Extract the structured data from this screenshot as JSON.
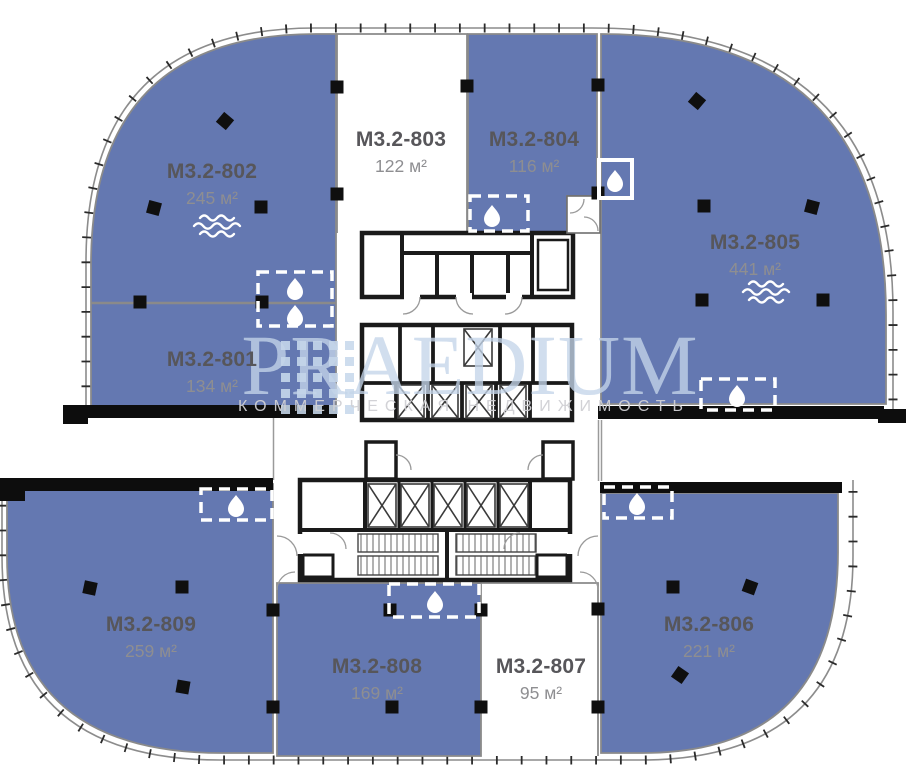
{
  "plan": {
    "name": "Floor plan M3.2 — level 8",
    "background": "#ffffff"
  },
  "watermark": {
    "title": "PRAEDIUM",
    "subtitle": "КОММЕРЧЕСКАЯ НЕДВИЖИМОСТЬ"
  },
  "colors": {
    "available_fill": "#6478b1",
    "unavailable_fill": "#ffffff",
    "wall": "#111111",
    "boundary_line": "#8a8a8a",
    "unit_name_text": "#57565a",
    "unit_area_text": "#8e8e91"
  },
  "units": [
    {
      "id": "M3.2-801",
      "area": "134 м²",
      "status": "available"
    },
    {
      "id": "M3.2-802",
      "area": "245 м²",
      "status": "available",
      "has_wave_icon": true
    },
    {
      "id": "M3.2-803",
      "area": "122 м²",
      "status": "unavailable"
    },
    {
      "id": "M3.2-804",
      "area": "116 м²",
      "status": "available"
    },
    {
      "id": "M3.2-805",
      "area": "441 м²",
      "status": "available",
      "has_wave_icon": true
    },
    {
      "id": "M3.2-806",
      "area": "221 м²",
      "status": "available"
    },
    {
      "id": "M3.2-807",
      "area": "95 м²",
      "status": "unavailable"
    },
    {
      "id": "M3.2-808",
      "area": "169 м²",
      "status": "available"
    },
    {
      "id": "M3.2-809",
      "area": "259 м²",
      "status": "available"
    }
  ],
  "symbols": {
    "wet_point": "water-drop-in-dashed-box",
    "wave": "ventilation-waves",
    "column": "black-square",
    "elevator": "crossed-box",
    "stairs": "hatched-treads"
  }
}
